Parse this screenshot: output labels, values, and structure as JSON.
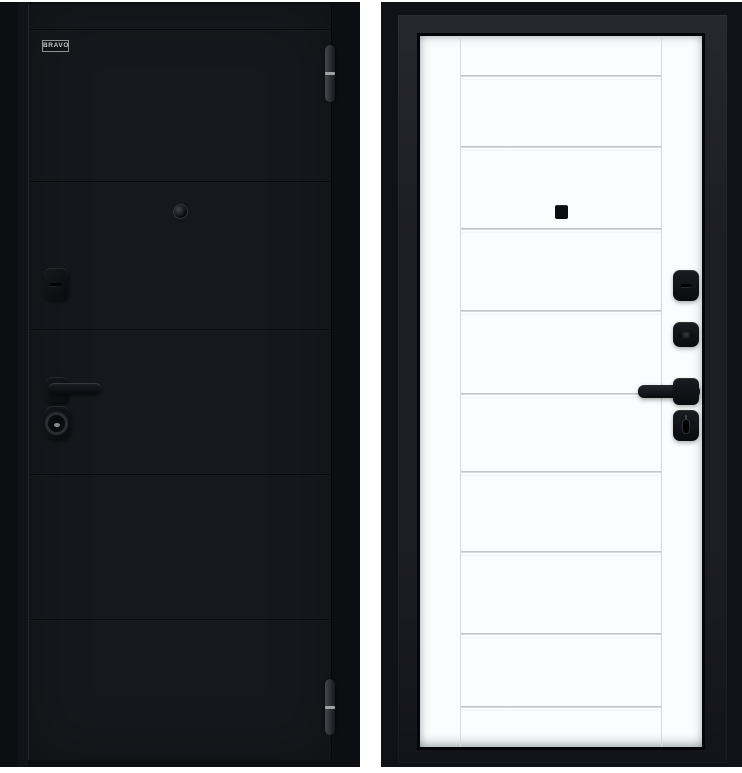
{
  "image_description": "entry-door-product-photo-two-sides",
  "background_color": "#ffffff",
  "left_door": {
    "side": "exterior",
    "brand_label": "BRAVO",
    "finish_color": "#17181d",
    "backdrop_color": "#0d0e12",
    "groove_count": 5,
    "hinge_count": 2,
    "hardware": [
      "keyhole-cover",
      "peephole",
      "lever-handle",
      "cylinder-escutcheon"
    ]
  },
  "right_door": {
    "side": "interior",
    "leaf_color": "#fbfcfd",
    "frame_color": "#111217",
    "molding_groove_count": 9,
    "hardware": [
      "lock-cover-top",
      "lock-cover-middle",
      "lever-handle",
      "thumbturn-escutcheon",
      "peephole"
    ]
  }
}
